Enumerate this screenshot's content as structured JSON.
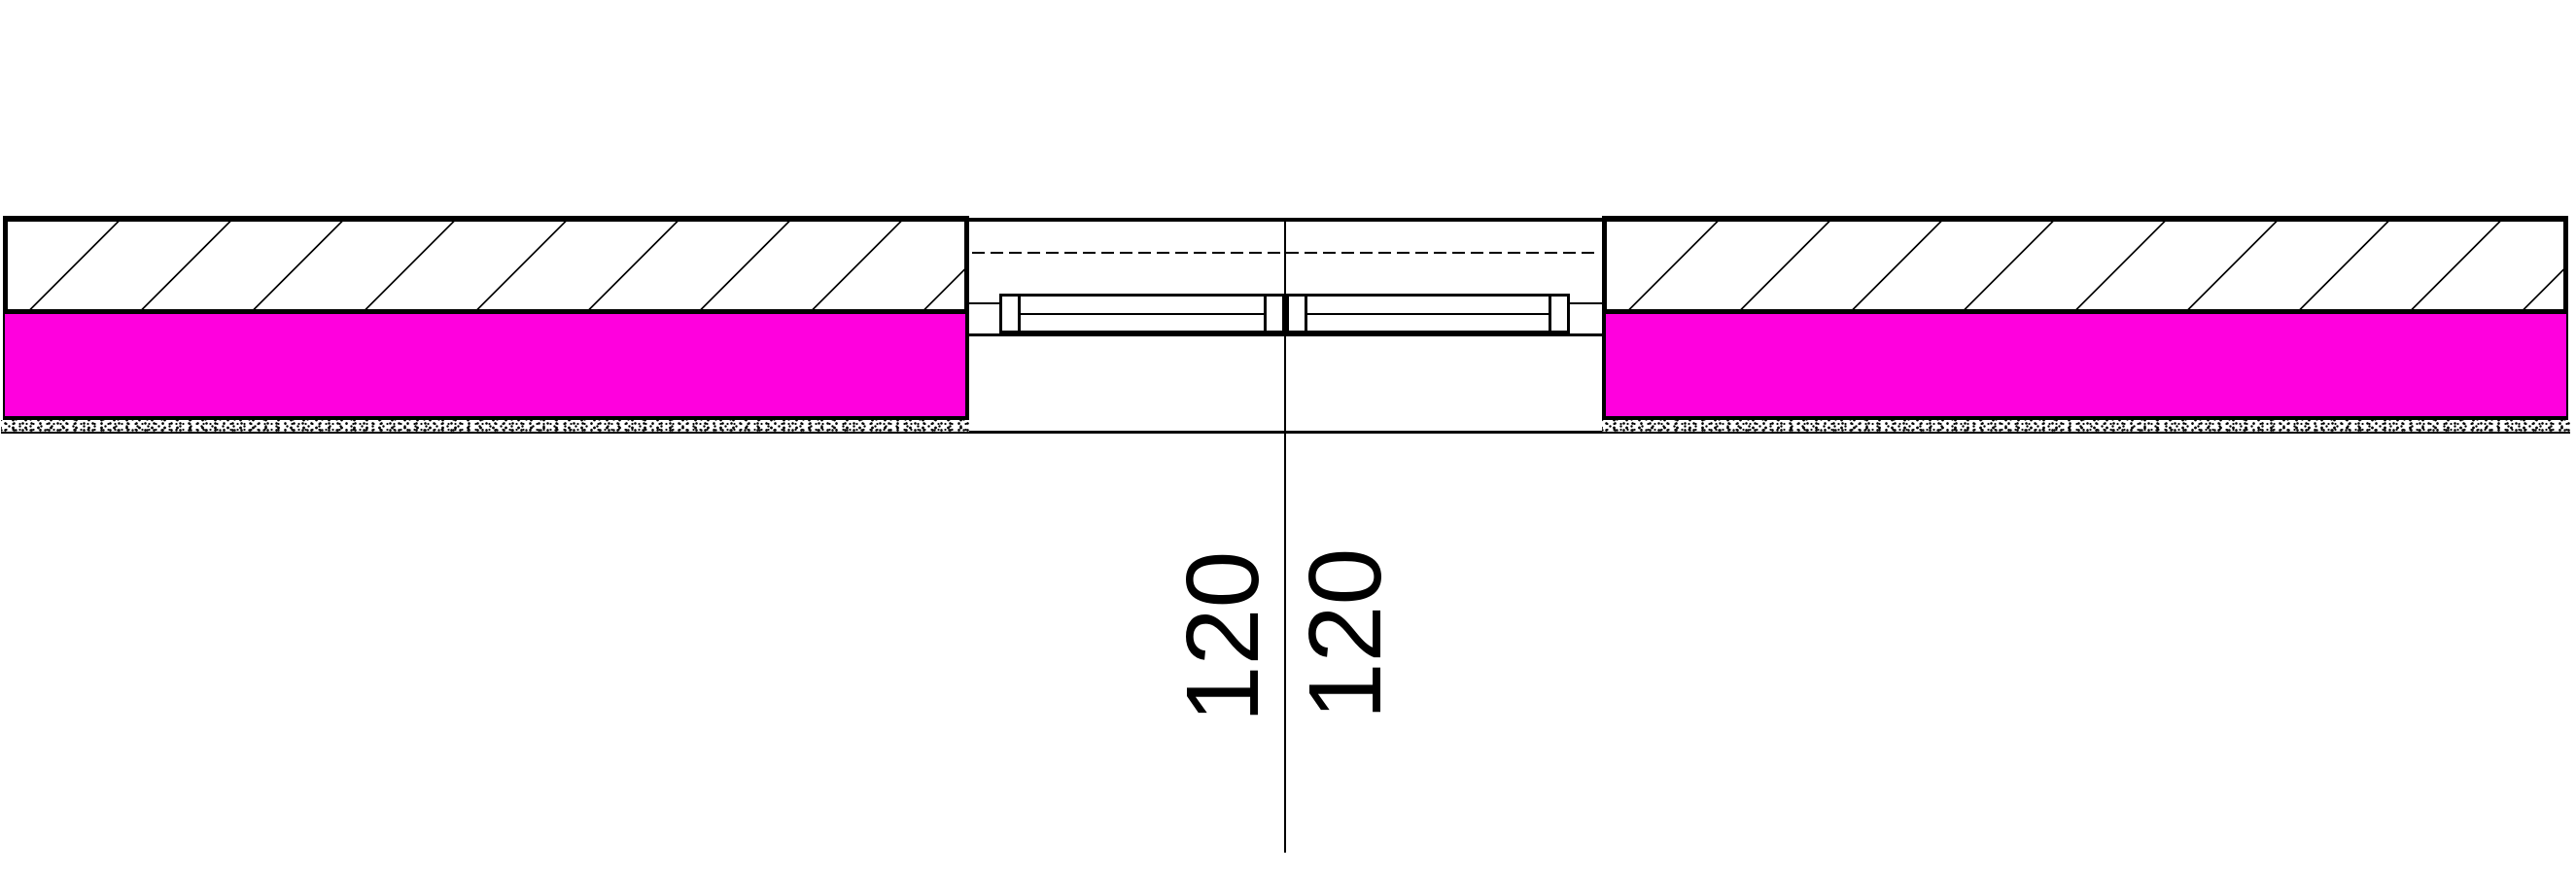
{
  "dimensions": {
    "left": "120",
    "right": "120"
  },
  "colors": {
    "insulation_fill": "#ff00de",
    "line": "#000000",
    "background": "#ffffff"
  }
}
